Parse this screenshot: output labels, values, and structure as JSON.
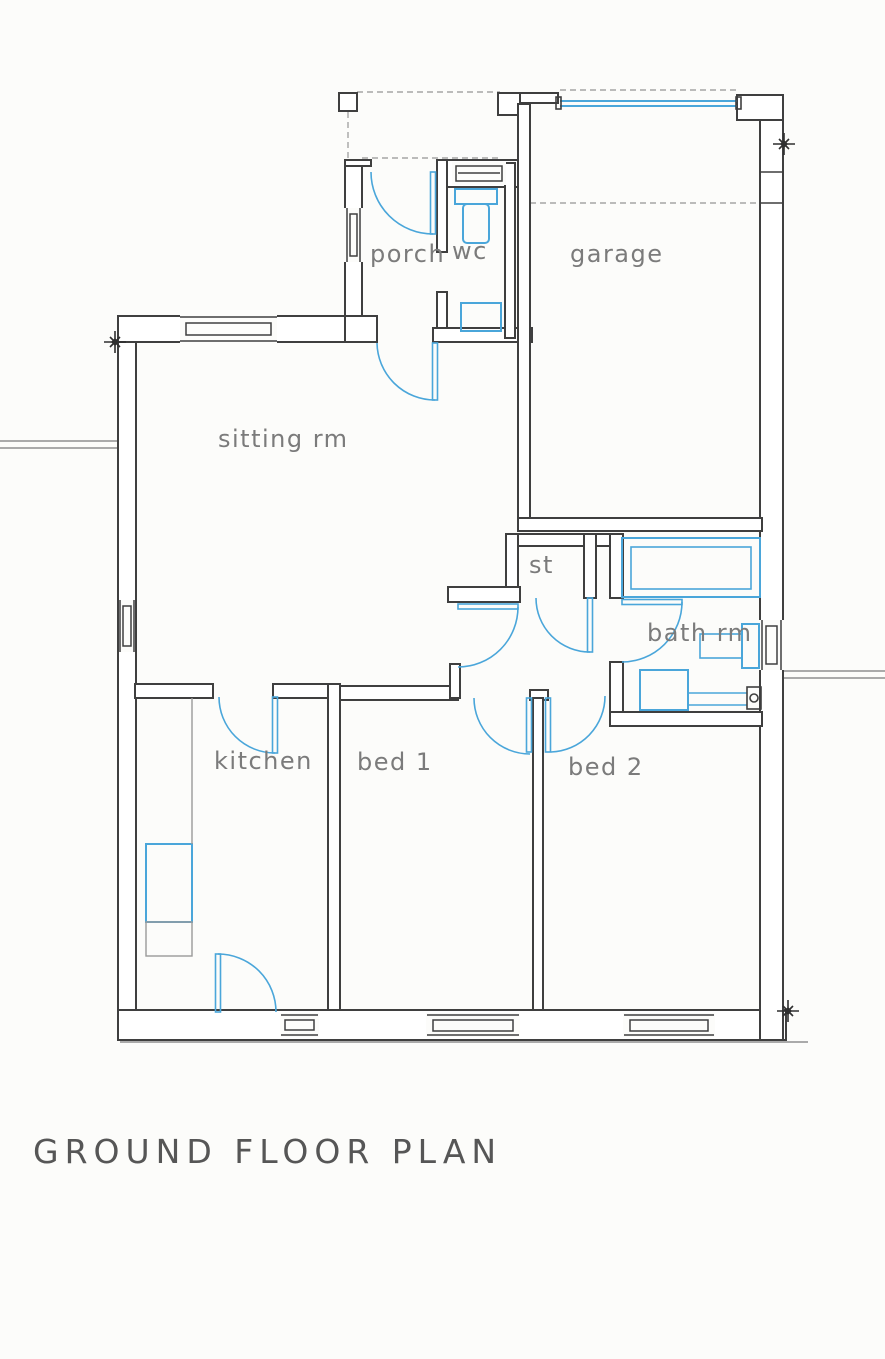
{
  "title": {
    "text": "GROUND FLOOR PLAN"
  },
  "rooms": [
    {
      "id": "porch",
      "label": "porch"
    },
    {
      "id": "wc",
      "label": "wc"
    },
    {
      "id": "garage",
      "label": "garage"
    },
    {
      "id": "sitting-room",
      "label": "sitting rm"
    },
    {
      "id": "store",
      "label": "st"
    },
    {
      "id": "bathroom",
      "label": "bath rm"
    },
    {
      "id": "kitchen",
      "label": "kitchen"
    },
    {
      "id": "bed1",
      "label": "bed 1"
    },
    {
      "id": "bed2",
      "label": "bed 2"
    }
  ],
  "colors": {
    "wall_line": "#3f3f3f",
    "fixture_blue": "#4aa6da",
    "pencil_gray": "#7b7b7b",
    "title_gray": "#565656",
    "background": "#fcfcfa"
  },
  "symbols": [
    "door-swing-arc",
    "window",
    "garage-door",
    "bathtub",
    "toilet",
    "wash-basin",
    "kitchen-counter",
    "storage-cupboard",
    "survey-cross-marker",
    "canopy-dashed-line",
    "boundary-line",
    "entrance-pillar"
  ]
}
